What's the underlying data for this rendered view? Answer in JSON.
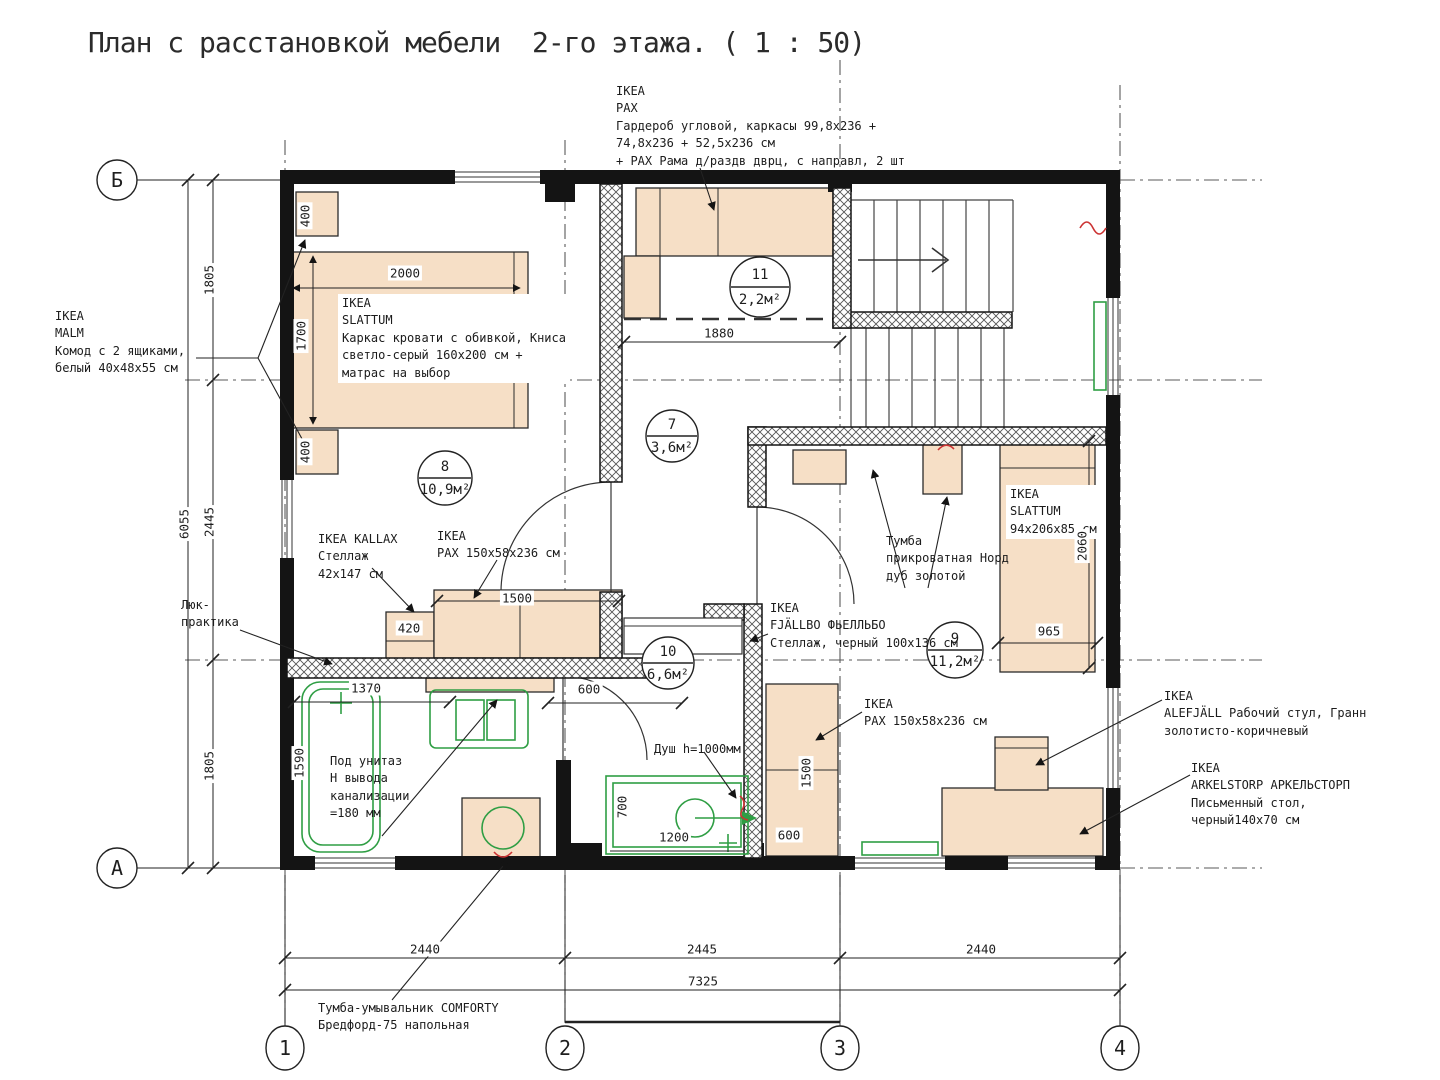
{
  "title": "План с расстановкой мебели  2-го этажа. ( 1 : 50)",
  "annotations": {
    "pax_corner": "IKEA\nPAX\nГардероб угловой, каркасы 99,8x236 +\n74,8x236 + 52,5x236 см\n+ PAX Рама д/раздв дврц, с направл, 2 шт",
    "malm": "IKEA\nMALM\nКомод с 2 ящиками,\nбелый 40x48x55 см",
    "slattum_bed": "IKEA\nSLATTUM\nКаркас кровати с обивкой, Книса\nсветло-серый 160x200 см +\nматрас на выбор",
    "kallax": "IKEA KALLAX\nСтеллаж\n42x147 см",
    "pax_wardrobe": "IKEA\nPAX 150x58x236 см",
    "bedside_nord": "Тумба\nприкроватная Норд\nдуб золотой",
    "slattum_single": "IKEA\nSLATTUM\n94x206x85 см",
    "fjallbo": "IKEA\nFJÄLLBO ФЬЕЛЛЬБО\nСтеллаж, черный 100x136 см",
    "pax_wardrobe_2": "IKEA\nPAX 150x58x236 см",
    "alefjall": "IKEA\nALEFJÄLL Рабочий стул, Гранн\nзолотисто-коричневый",
    "arkelstorp": "IKEA\nARKELSTORP АРКЕЛЬСТОРП\nПисьменный стол,\nчерный140x70 см",
    "hatch_note": "Люк-\nпрактика",
    "toilet_note": "Под унитаз\nН вывода\nканализации\n=180 мм",
    "shower_note": "Душ h=1000мм",
    "comforty": "Тумба-умывальник COMFORTY\nБредфорд-75 напольная"
  },
  "rooms": {
    "r8": {
      "num": "8",
      "area": "10,9м²"
    },
    "r7": {
      "num": "7",
      "area": "3,6м²"
    },
    "r11": {
      "num": "11",
      "area": "2,2м²"
    },
    "r10": {
      "num": "10",
      "area": "6,6м²"
    },
    "r9": {
      "num": "9",
      "area": "11,2м²"
    }
  },
  "axes": {
    "b": "Б",
    "a": "А",
    "c1": "1",
    "c2": "2",
    "c3": "3",
    "c4": "4"
  },
  "dims": {
    "bed_w": "2000",
    "bed_h": "1700",
    "malm_top": "400",
    "malm_bot": "400",
    "left_top": "1805",
    "left_total": "6055",
    "left_mid": "2445",
    "left_bot": "1805",
    "nook_w": "1880",
    "bed9_h": "2060",
    "bed9_w": "965",
    "kallax_w": "420",
    "pax_w": "1500",
    "pax_d": "600",
    "bath_w": "1370",
    "bath_h": "1590",
    "shower_d": "700",
    "shower_w": "1200",
    "pax2_h": "1500",
    "pax2_w": "600",
    "span12": "2440",
    "span23": "2445",
    "span34": "2440",
    "total": "7325"
  },
  "colors": {
    "furniture": "#f6dfc6",
    "fixture_green": "#2f9e44",
    "wall": "#141414",
    "accent_red": "#cc3333"
  }
}
